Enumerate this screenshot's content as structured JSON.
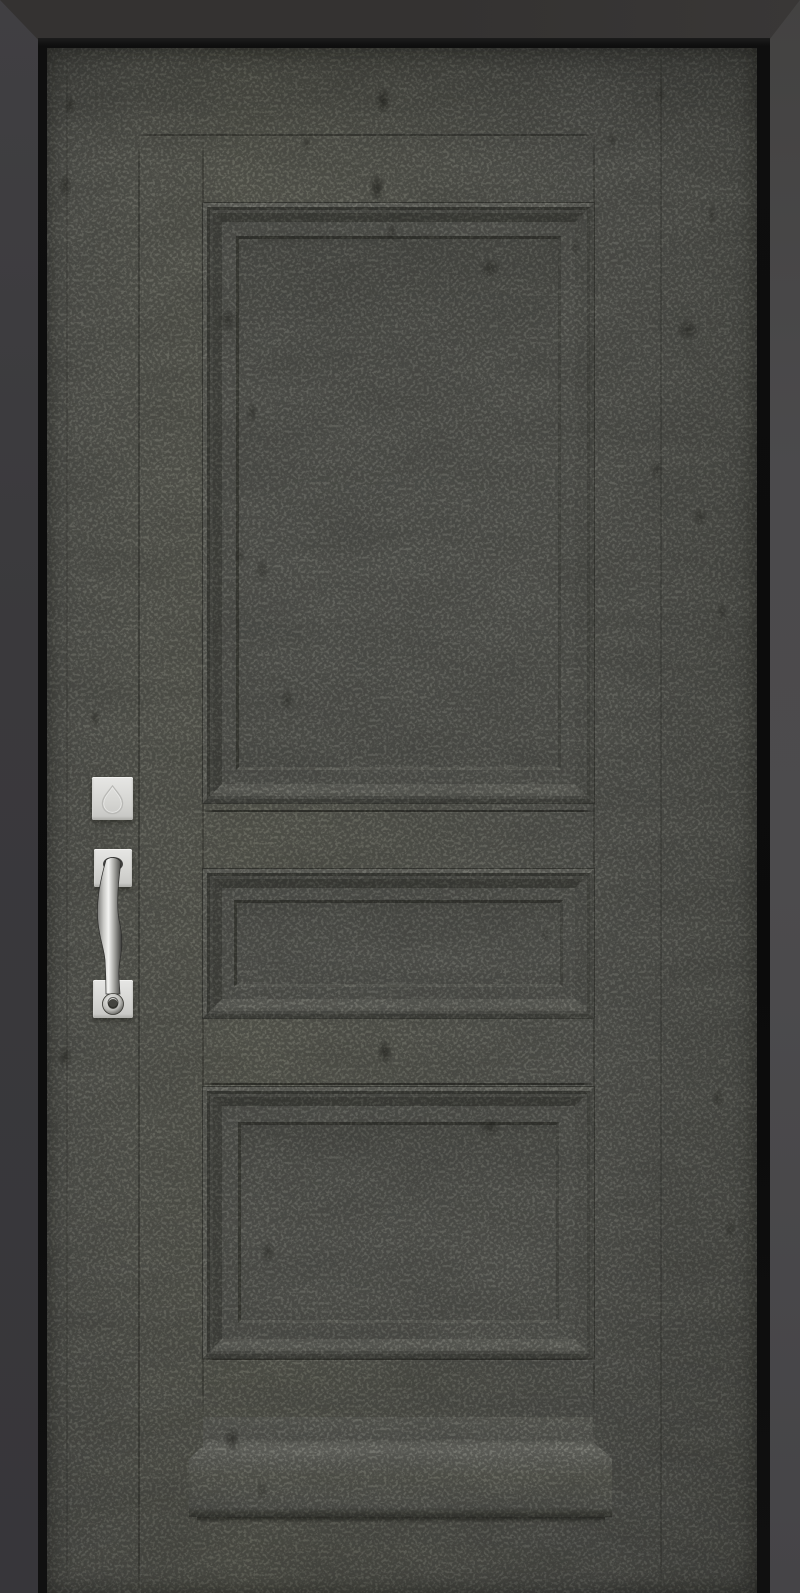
{
  "window": {
    "width_px": 800,
    "height_px": 1593
  },
  "scene": {
    "subject": "closed single entry door, straight-on front view, 3D render",
    "door_style": "classic three-panel door: tall upper panel, narrow middle panel, medium lower panel, stepped applied moldings, flared plinth base block",
    "finish": "distressed slate-gray paint with dark speckles, scuffs and scratch marks",
    "surround": "dark charcoal door jamb with near-black inner frame reveal, mitered corners at top"
  },
  "colors": {
    "wall-left": "#3a393c",
    "wall-left-top": "#403f42",
    "wall-left-bottom": "#37363a",
    "wall-top": "#343231",
    "wall-right": "#4b4a4c",
    "frame-black": "#0d0d0d",
    "door-base": "#64655f",
    "panel-face": "#60615b",
    "molding-dark": "#3f403a",
    "molding-light": "#73746d",
    "mark-dark": "#2c2c28",
    "hardware-light": "#e6e6e4",
    "hardware-mid": "#d2d2cf",
    "hardware-shadow": "#9c9c99",
    "grip-highlight": "#f4f4f2",
    "grip-dark": "#343432"
  },
  "door": {
    "panels": [
      {
        "name": "top panel",
        "shape": "tall vertical rectangle",
        "molding": "multi-step recessed"
      },
      {
        "name": "middle panel",
        "shape": "wide shallow rectangle",
        "molding": "multi-step recessed"
      },
      {
        "name": "bottom panel",
        "shape": "wide medium rectangle",
        "molding": "multi-step recessed"
      }
    ],
    "base": "plinth block flaring wider than panel column, concave side fillets",
    "texture_marks": "scattered dark distress blotches and fine speckle grain, faint vertical plank seams"
  },
  "hardware": {
    "finish": "satin nickel / brushed silver",
    "position": "left stile of door",
    "items": [
      {
        "name": "deadbolt escutcheon",
        "detail": "square plate with embossed teardrop keyhole outline"
      },
      {
        "name": "handleset pull",
        "detail": "S-curved vertical grip spanning two square mounting plates, ring terminal over lower plate"
      }
    ]
  }
}
